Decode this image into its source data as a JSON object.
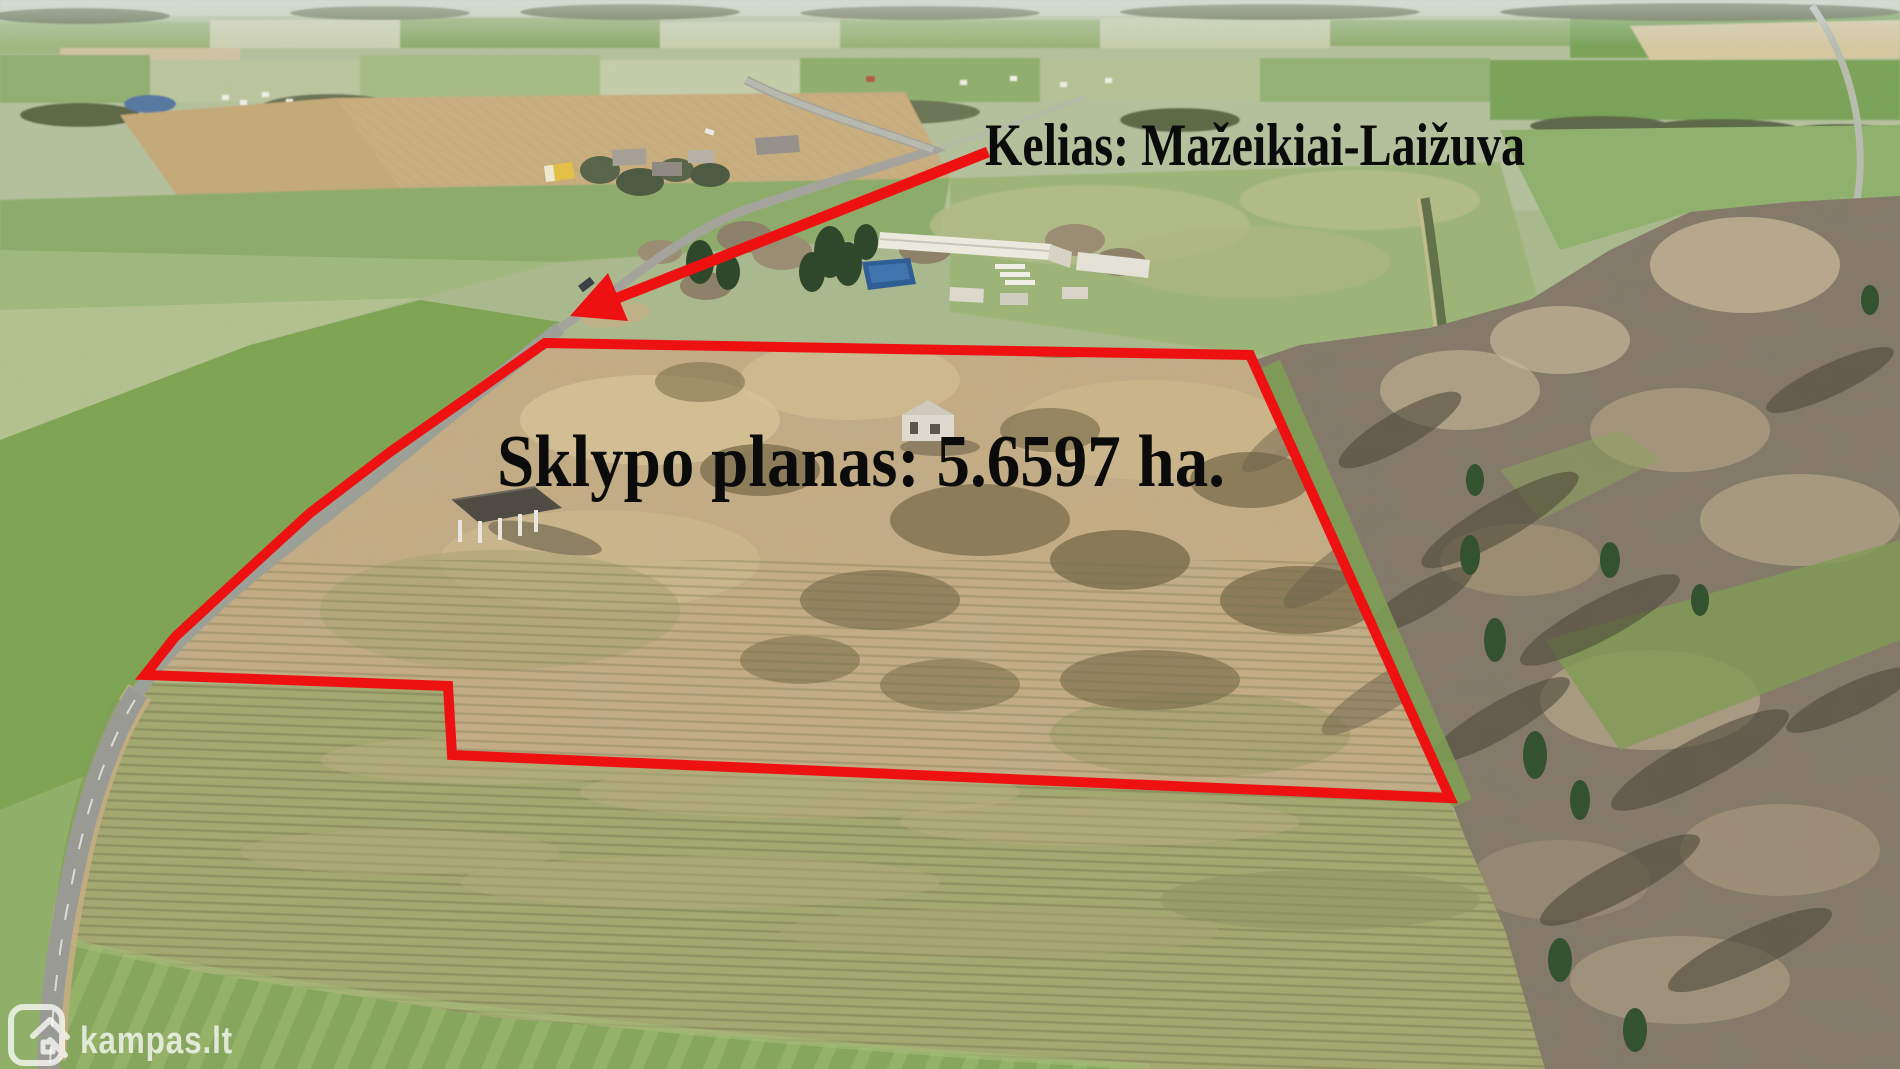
{
  "image": {
    "kind": "aerial-drone-photo",
    "scene": "Rural farmland with a land plot outlined in red, road and forest",
    "width_px": 1900,
    "height_px": 1069
  },
  "annotations": {
    "road_label": "Kelias: Mažeikiai-Laižuva",
    "plot_label": "Sklypo planas: 5.6597 ha.",
    "plot_area_ha": "5.6597",
    "boundary_color": "#ee1111",
    "label_color": "#0b0b0b"
  },
  "watermark": {
    "text": "kampas.lt",
    "icon": "kampas-door-house-icon",
    "color_white_alpha": "rgba(255,255,255,0.72)"
  }
}
